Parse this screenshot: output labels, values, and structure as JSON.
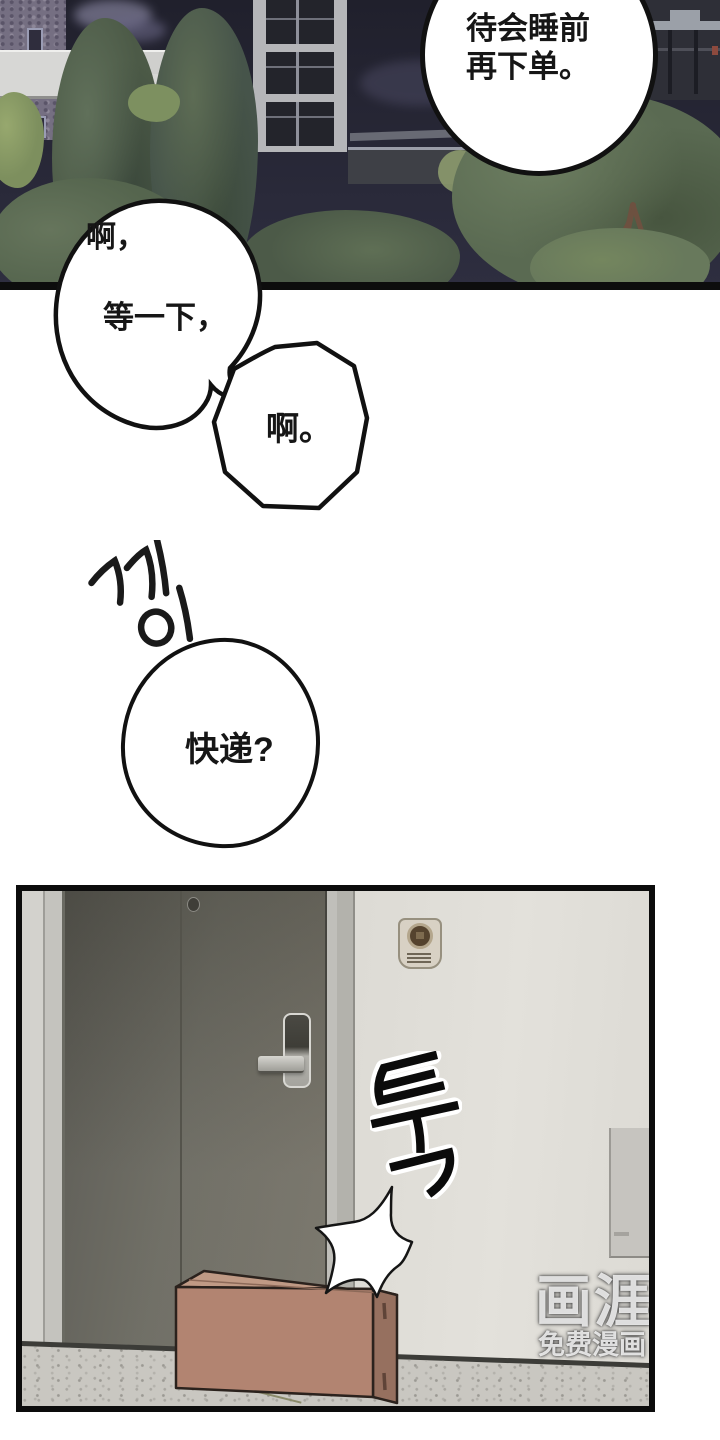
{
  "speech": {
    "order": {
      "line1": "待会睡前",
      "line2": "再下单。"
    },
    "wait": {
      "interjection": "啊，",
      "main": "等一下，"
    },
    "ah": {
      "text": "啊。"
    },
    "delivery": {
      "text": "快递?"
    }
  },
  "sfx": {
    "door_creak": "끼이",
    "thud": "툭"
  },
  "watermark": {
    "logo": "画涯",
    "tagline": "免费漫画"
  },
  "colors": {
    "outline": "#111111",
    "sky_top": "#20202c",
    "sky_bottom": "#2e2e40",
    "tree_mid": "#4c5a47",
    "door": "#6b6a61",
    "wall": "#d9d7d1",
    "floor": "#c9c7c1",
    "box_front": "#b28471",
    "box_top": "#c09a85",
    "box_side": "#96705f"
  }
}
